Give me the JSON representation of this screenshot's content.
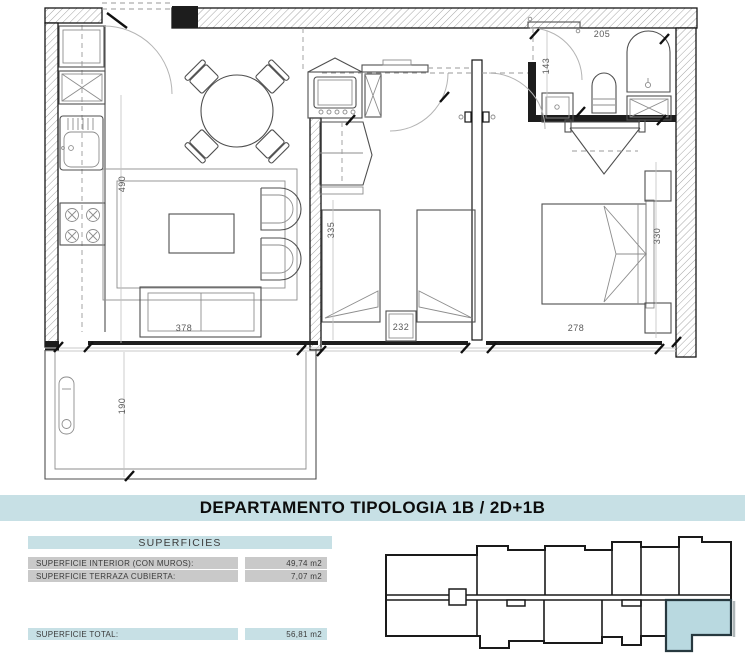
{
  "banner": {
    "title": "DEPARTAMENTO TIPOLOGIA 1B / 2D+1B"
  },
  "superficies": {
    "header": "SUPERFICIES",
    "rows": [
      {
        "label": "SUPERFICIE INTERIOR (CON MUROS):",
        "value": "49,74 m2"
      },
      {
        "label": "SUPERFICIE TERRAZA CUBIERTA:",
        "value": "7,07 m2"
      }
    ],
    "total_label": "SUPERFICIE TOTAL:",
    "total_value": "56,81 m2"
  },
  "plan": {
    "dims": {
      "living_depth": "490",
      "living_width": "378",
      "bed2_depth": "335",
      "bed2_width": "232",
      "bed1_width": "278",
      "bed1_depth": "330",
      "terrace_depth": "190",
      "bath_width": "205",
      "hall_depth": "143"
    }
  },
  "colors": {
    "accent": "#c7e0e5",
    "row_gray": "#c9c9c9",
    "highlight_fill": "#b9d9e0",
    "highlight_stroke": "#27393f"
  }
}
